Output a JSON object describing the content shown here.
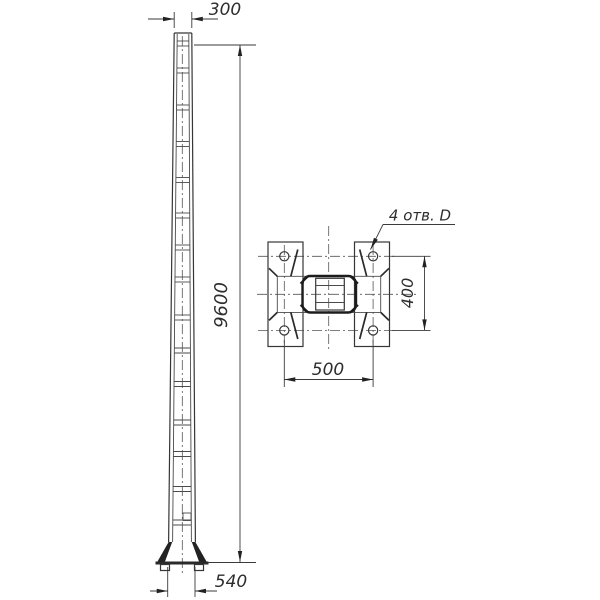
{
  "drawing": {
    "kind": "engineering drawing — tapered lighting pole, elevation and base-plate plan",
    "annotations": {
      "top_width": "300",
      "pole_height": "9600",
      "base_width": "540",
      "bolt_spacing_width": "500",
      "bolt_spacing_height": "400",
      "holes_callout": "4 отв. D"
    },
    "colors": {
      "background": "#ffffff",
      "line_thin": "#4a4a4a",
      "line_medium": "#363636",
      "line_thick": "#1c1c1c",
      "text": "#2d2d2d"
    }
  }
}
